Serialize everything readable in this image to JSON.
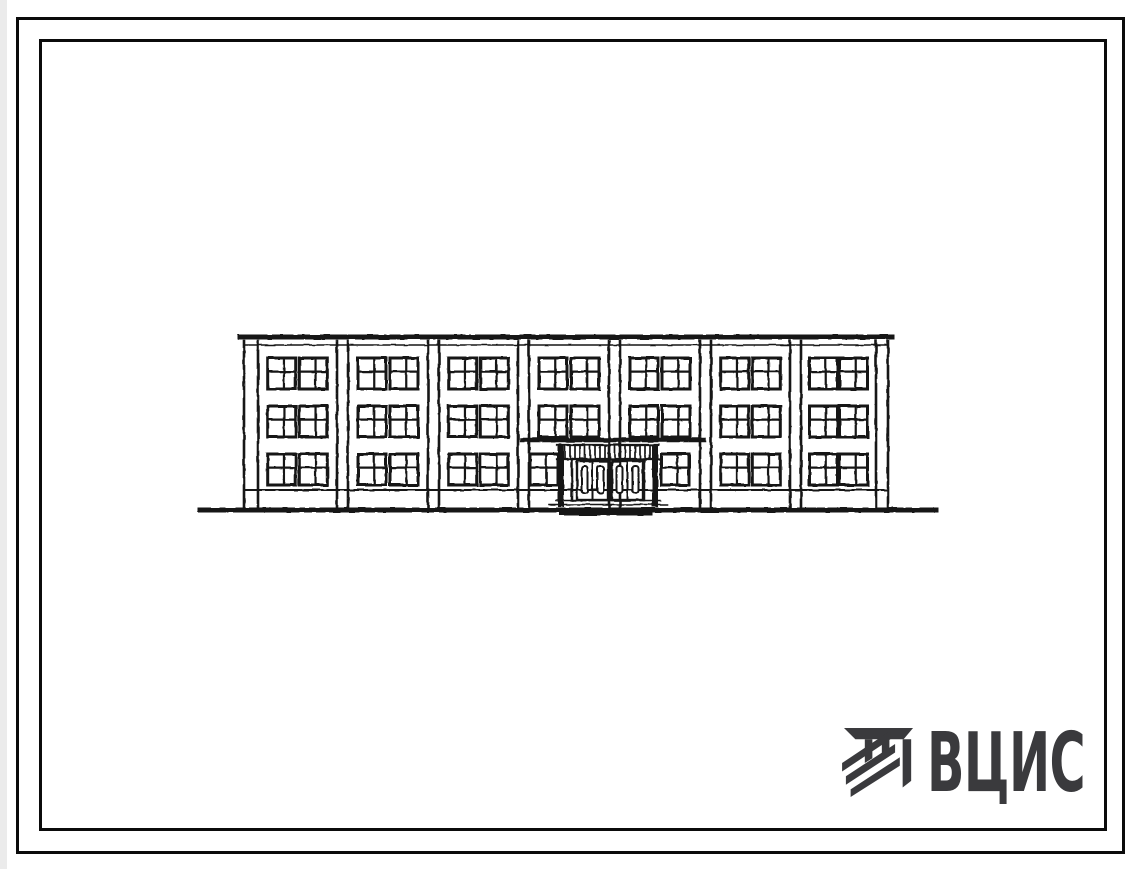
{
  "page": {
    "background": "#ffffff",
    "left_edge_shade": "#ebebeb"
  },
  "frame": {
    "color": "#0b0b0b",
    "outer": {
      "x": 16,
      "y": 17,
      "w": 1109,
      "h": 837,
      "stroke": 3
    },
    "inner": {
      "x": 39,
      "y": 39,
      "w": 1068,
      "h": 792,
      "stroke": 3
    }
  },
  "drawing": {
    "subject": "three-storey-building-front-elevation",
    "ink": "#151515",
    "ground": {
      "x1": 200,
      "x2": 936,
      "y": 510,
      "stroke": 5
    },
    "building": {
      "left": 244,
      "right": 888,
      "top": 337,
      "base_line_y": 490,
      "bottom": 508
    },
    "parapet": {
      "thick_y": 337,
      "thick_stroke": 5,
      "thin_y": 345,
      "thin_stroke": 1.6
    },
    "pilaster_x": [
      244,
      258,
      337,
      348,
      428,
      439,
      518,
      529,
      609,
      620,
      700,
      711,
      790,
      801,
      876,
      888
    ],
    "pilaster_stroke": 2.6,
    "floors": {
      "count": 3,
      "row_tops": [
        358,
        406,
        454
      ],
      "window_h": 31
    },
    "bays": {
      "count": 7,
      "windows_per_bay": 2,
      "window_w": 28,
      "centers": [
        0.3,
        0.7
      ]
    },
    "window_style": {
      "frame_stroke": 3,
      "mullion_stroke": 2.2,
      "mullion_x": 0.58,
      "transom_y": 0.44
    },
    "entrance": {
      "left_bay": 3,
      "right_bay": 4,
      "side_window_left_x": 530,
      "side_window_right_x": 661,
      "canopy_line": {
        "x1": 522,
        "x2": 704,
        "y": 440,
        "stroke": 4.5
      },
      "fascia": {
        "x1": 557,
        "x2": 659,
        "y1": 445,
        "y2": 459,
        "tick_step": 5,
        "tick_stroke": 1.7,
        "edge_stroke": 2.2
      },
      "posts": {
        "left_x": 558,
        "right_x": 652,
        "w": 6,
        "y1": 445,
        "y2": 507
      },
      "inner_posts": {
        "left_x": 572,
        "right_x": 644,
        "y1": 459,
        "y2": 500,
        "stroke": 2.5
      },
      "doors": {
        "unit_x": [
          577,
          612
        ],
        "w": 31,
        "y1": 461,
        "y2": 500,
        "frame_stroke": 2.4,
        "slot_w": 6,
        "slot_y1": 466,
        "slot_y2": 493
      },
      "center_post": {
        "x": 608.5,
        "w": 3
      },
      "steps": [
        {
          "x1": 556,
          "x2": 660,
          "y": 500.5
        },
        {
          "x1": 549,
          "x2": 667,
          "y": 504.5
        }
      ],
      "pad": {
        "x1": 562,
        "x2": 650,
        "y": 513,
        "stroke": 5
      }
    }
  },
  "logo": {
    "text": "ВЦИС",
    "color": "#3a3a3d",
    "icon": "vcis-construction-emblem"
  }
}
